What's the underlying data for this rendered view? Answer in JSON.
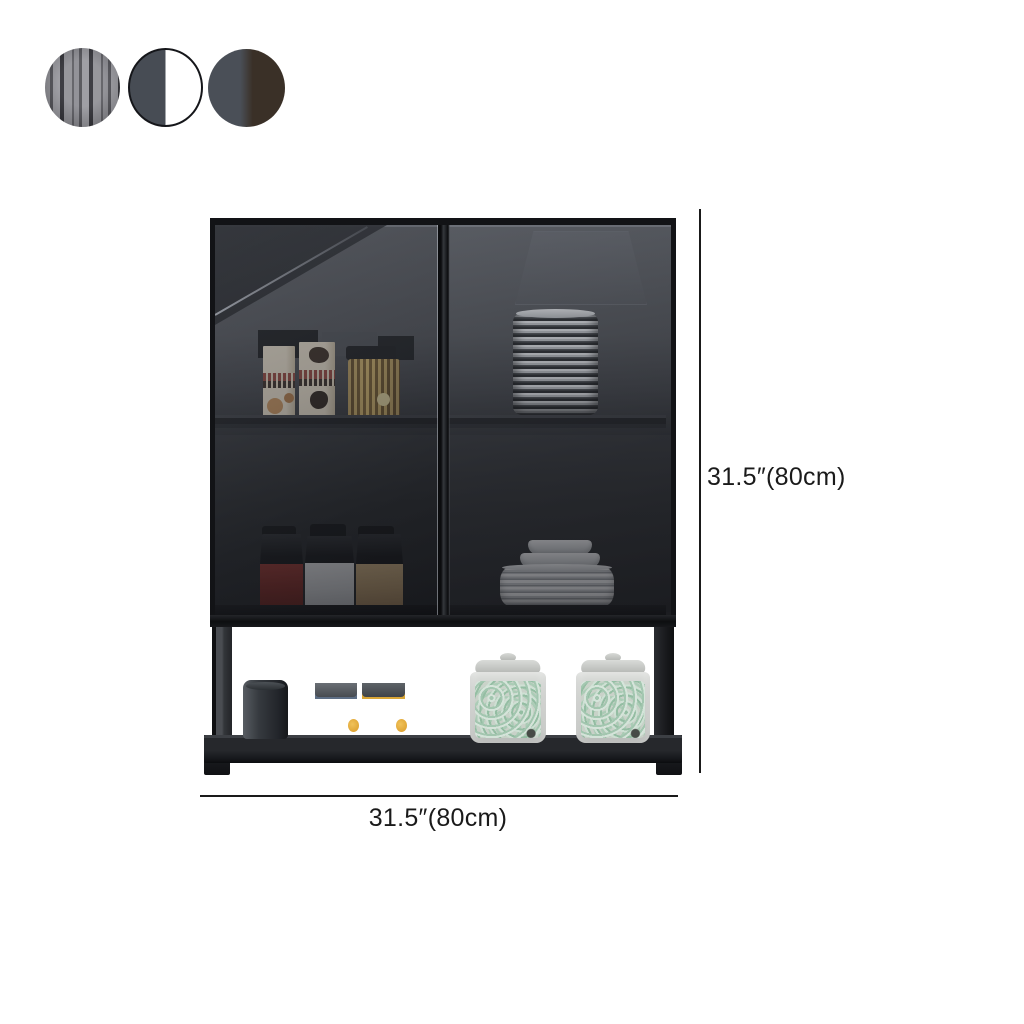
{
  "dimensions": {
    "height_label": "31.5″(80cm)",
    "width_label": "31.5″(80cm)"
  },
  "swatches": {
    "options": [
      {
        "name": "fluted-gray",
        "base": "#8a8a90",
        "stripe": "#2e2e34"
      },
      {
        "name": "gray-and-white",
        "left": "#474c54",
        "right": "#ffffff"
      },
      {
        "name": "gray-and-brown",
        "left": "#4a4f57",
        "right": "#3a3027"
      }
    ]
  },
  "cabinet": {
    "type": "wall-mounted cabinet with two smoked-glass doors and open lower shelf",
    "finish": "black",
    "contents": {
      "upper_left_shelf": [
        "food-box",
        "food-box",
        "pasta-jar"
      ],
      "upper_right_shelf": [
        "plate-stack"
      ],
      "lower_left_shelf": [
        "spice-jars",
        "canister-red",
        "canister-white",
        "canister-tan"
      ],
      "lower_right_shelf": [
        "bowl-stack",
        "plate-pile"
      ],
      "open_shelf": [
        "dark-canister",
        "spice-bottle-blue-label",
        "spice-bottle-yellow-label",
        "noodle-jar",
        "noodle-jar"
      ]
    }
  },
  "colors": {
    "bg": "#ffffff",
    "ann": "#1a1a1a",
    "frame": "#121316",
    "swslate": "#474c54",
    "swgray": "#4a4f57",
    "swbrown": "#3a3027",
    "amber": "#a85a1b",
    "labelblue": "#5d6e85",
    "labelyellow": "#d9a637",
    "green": "#9fc6ad"
  }
}
